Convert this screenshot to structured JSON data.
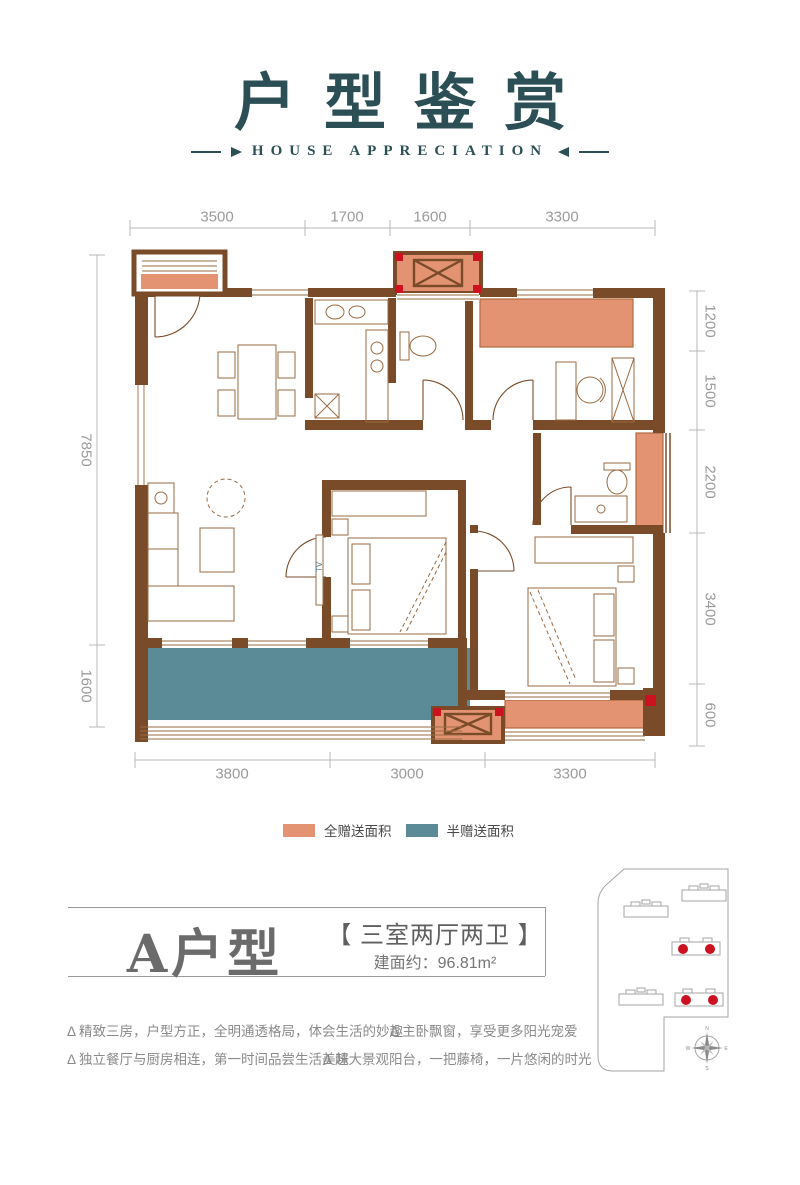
{
  "colors": {
    "title_teal": "#2b4f55",
    "wall_brown": "#7a4b28",
    "furniture_brown": "#9a6b42",
    "full_gift_orange": "#e39371",
    "half_gift_teal": "#5b8b97",
    "dim_gray": "#9b9b9b",
    "highlight_red": "#cc1120"
  },
  "header": {
    "title": "户型鉴赏",
    "subtitle": "HOUSE APPRECIATION"
  },
  "floorplan": {
    "dims_top": [
      "3500",
      "1700",
      "1600",
      "3300"
    ],
    "dims_bottom": [
      "3800",
      "3000",
      "3300"
    ],
    "dims_left": [
      "7850",
      "1600"
    ],
    "dims_right": [
      "1200",
      "1500",
      "2200",
      "3400",
      "600"
    ],
    "tv_label": "TV"
  },
  "legend": {
    "full_gift": "全赠送面积",
    "half_gift": "半赠送面积"
  },
  "unit": {
    "name": "A户型",
    "layout": "【 三室两厅两卫 】",
    "area": "建面约：96.81m²"
  },
  "features": [
    "Δ 精致三房，户型方正，全明通透格局，体会生活的妙趣",
    "Δ 主卧飘窗，享受更多阳光宠爱",
    "Δ 独立餐厅与厨房相连，第一时间品尝生活美味",
    "Δ 超大景观阳台，一把藤椅，一片悠闲的时光"
  ],
  "compass": [
    "N",
    "E",
    "S",
    "W"
  ]
}
